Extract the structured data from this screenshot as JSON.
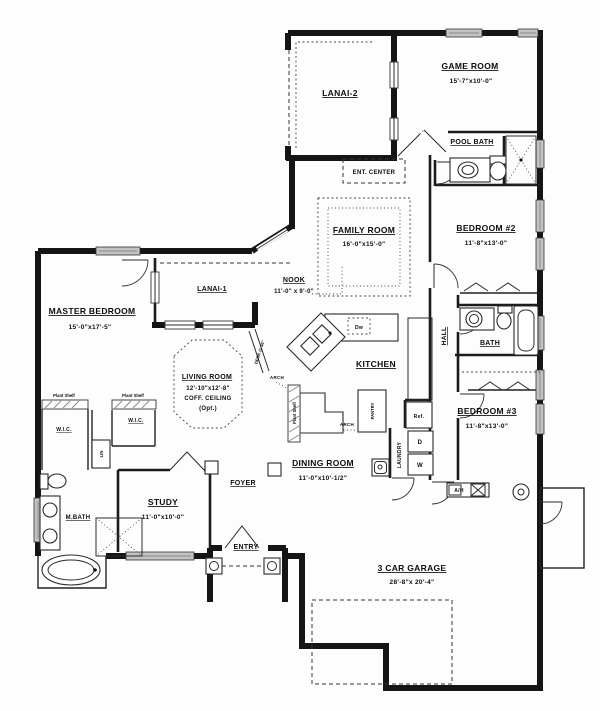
{
  "rooms": {
    "lanai2": {
      "name": "LANAI-2"
    },
    "game": {
      "name": "GAME ROOM",
      "dims": "15'-7\"x10'-0\""
    },
    "poolbath": {
      "name": "POOL BATH"
    },
    "entcenter": {
      "name": "ENT. CENTER"
    },
    "family": {
      "name": "FAMILY ROOM",
      "dims": "16'-0\"x15'-0\""
    },
    "bed2": {
      "name": "BEDROOM #2",
      "dims": "11'-8\"x13'-0\""
    },
    "nook": {
      "name": "NOOK",
      "dims": "11'-0\" x 9'-0\""
    },
    "lanai1": {
      "name": "LANAI-1"
    },
    "master": {
      "name": "MASTER BEDROOM",
      "dims": "15'-0\"x17'-5\""
    },
    "living": {
      "name": "LIVING ROOM",
      "dims": "12'-10\"x12'-8\"",
      "note1": "COFF. CEILING",
      "note2": "(Opt.)"
    },
    "kitchen": {
      "name": "KITCHEN"
    },
    "hall": {
      "name": "HALL"
    },
    "bath": {
      "name": "BATH"
    },
    "bed3": {
      "name": "BEDROOM #3",
      "dims": "11'-8\"x13'-0\""
    },
    "wic1": {
      "name": "W.I.C."
    },
    "wic2": {
      "name": "W.I.C."
    },
    "mbath": {
      "name": "M.BATH"
    },
    "study": {
      "name": "STUDY",
      "dims": "11'-0\"x10'-0\""
    },
    "foyer": {
      "name": "FOYER"
    },
    "dining": {
      "name": "DINING ROOM",
      "dims": "11'-0\"x10'-1/2\""
    },
    "laundry": {
      "name": "LAUNDRY"
    },
    "entry": {
      "name": "ENTRY"
    },
    "garage": {
      "name": "3 CAR GARAGE",
      "dims": "28'-8\"x 20'-4\""
    }
  },
  "labels": {
    "plant_shelf": "Plant Shelf",
    "arch": "ARCH",
    "ref": "Ref.",
    "dw": "Dw",
    "washer": "W",
    "dryer": "D",
    "pantry": "PANTRY",
    "lin": "LIN",
    "air_handler": "A/H",
    "desk": "DESK @ 36\""
  },
  "colors": {
    "wall": "#151515",
    "window_fill": "#c3c3c3",
    "paper": "#fdfdfd"
  }
}
